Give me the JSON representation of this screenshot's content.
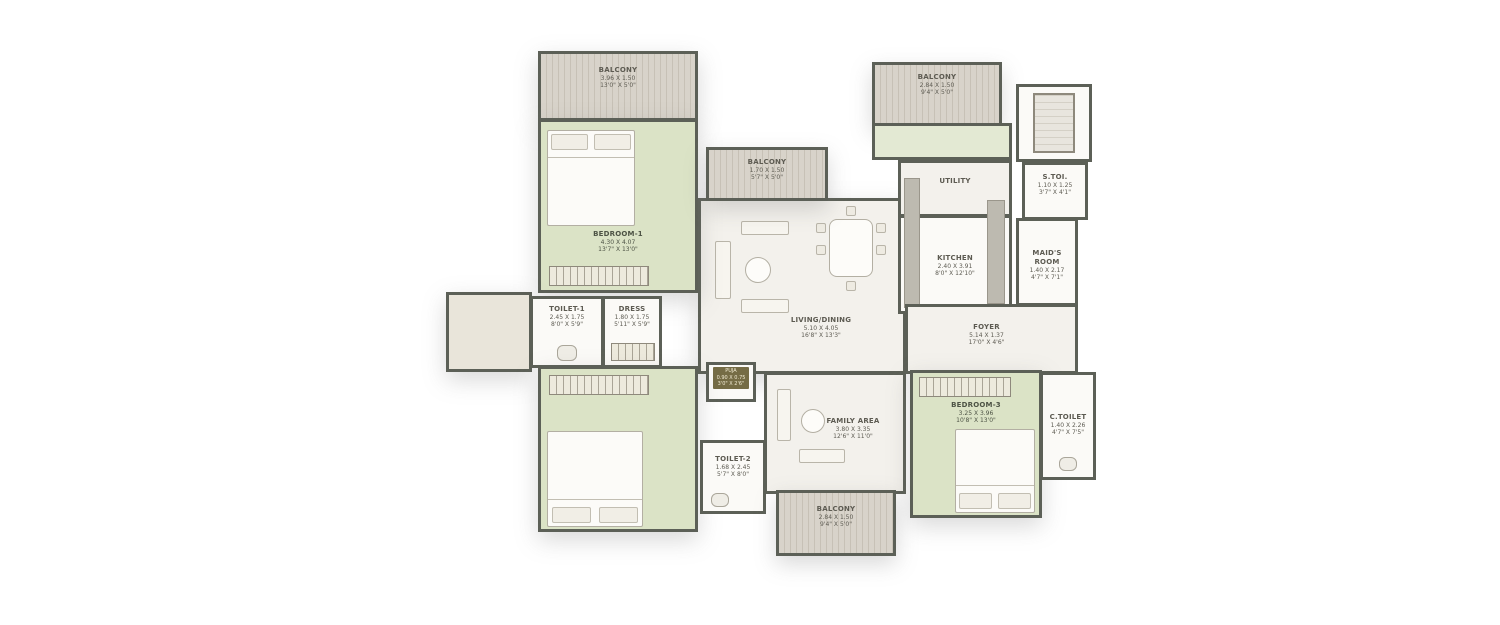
{
  "plan_title": "3 BHK + Maid's Room Floor Plan",
  "colors": {
    "wall": "#5c6057",
    "bedroom_fill": "#dbe3c6",
    "balcony_fill": "#d8d3ca",
    "floor_fill": "#f3f1ec",
    "puja_tag_bg": "#756c45"
  },
  "rooms": {
    "balcony_tl": {
      "name": "BALCONY",
      "dim_m": "3.96 X 1.50",
      "dim_ft": "13'0\" X 5'0\""
    },
    "bedroom1": {
      "name": "BEDROOM-1",
      "dim_m": "4.30 X 4.07",
      "dim_ft": "13'7\" X 13'0\""
    },
    "balcony_tc": {
      "name": "BALCONY",
      "dim_m": "1.70 X 1.50",
      "dim_ft": "5'7\" X 5'0\""
    },
    "balcony_tr": {
      "name": "BALCONY",
      "dim_m": "2.84 X 1.50",
      "dim_ft": "9'4\" X 5'0\""
    },
    "utility": {
      "name": "UTILITY"
    },
    "kitchen": {
      "name": "KITCHEN",
      "dim_m": "2.40 X 3.91",
      "dim_ft": "8'0\" X 12'10\""
    },
    "s_toi": {
      "name": "S.TOI.",
      "dim_m": "1.10 X 1.25",
      "dim_ft": "3'7\" X 4'1\""
    },
    "maids_room": {
      "name": "MAID'S ROOM",
      "dim_m": "1.40 X 2.17",
      "dim_ft": "4'7\" X 7'1\""
    },
    "toilet1": {
      "name": "TOILET-1",
      "dim_m": "2.45 X 1.75",
      "dim_ft": "8'0\" X 5'9\""
    },
    "dress": {
      "name": "DRESS",
      "dim_m": "1.80 X 1.75",
      "dim_ft": "5'11\" X 5'9\""
    },
    "living": {
      "name": "LIVING/DINING",
      "dim_m": "5.10 X 4.05",
      "dim_ft": "16'8\" X 13'3\""
    },
    "foyer": {
      "name": "FOYER",
      "dim_m": "5.14 X 1.37",
      "dim_ft": "17'0\" X 4'6\""
    },
    "puja": {
      "name": "PUJA",
      "dim_m": "0.90 X 0.75",
      "dim_ft": "3'0\" X 2'6\""
    },
    "bedroom2": {
      "name": "BEDROOM-2",
      "dim_m": "4.06 X 4.27",
      "dim_ft": "13'1\" X 14'0\""
    },
    "toilet2": {
      "name": "TOILET-2",
      "dim_m": "1.68 X 2.45",
      "dim_ft": "5'7\" X 8'0\""
    },
    "family": {
      "name": "FAMILY AREA",
      "dim_m": "3.80 X 3.35",
      "dim_ft": "12'6\" X 11'0\""
    },
    "bedroom3": {
      "name": "BEDROOM-3",
      "dim_m": "3.25 X 3.96",
      "dim_ft": "10'8\" X 13'0\""
    },
    "c_toilet": {
      "name": "C.TOILET",
      "dim_m": "1.40 X 2.26",
      "dim_ft": "4'7\" X 7'5\""
    },
    "balcony_b": {
      "name": "BALCONY",
      "dim_m": "2.84 X 1.50",
      "dim_ft": "9'4\" X 5'0\""
    }
  }
}
